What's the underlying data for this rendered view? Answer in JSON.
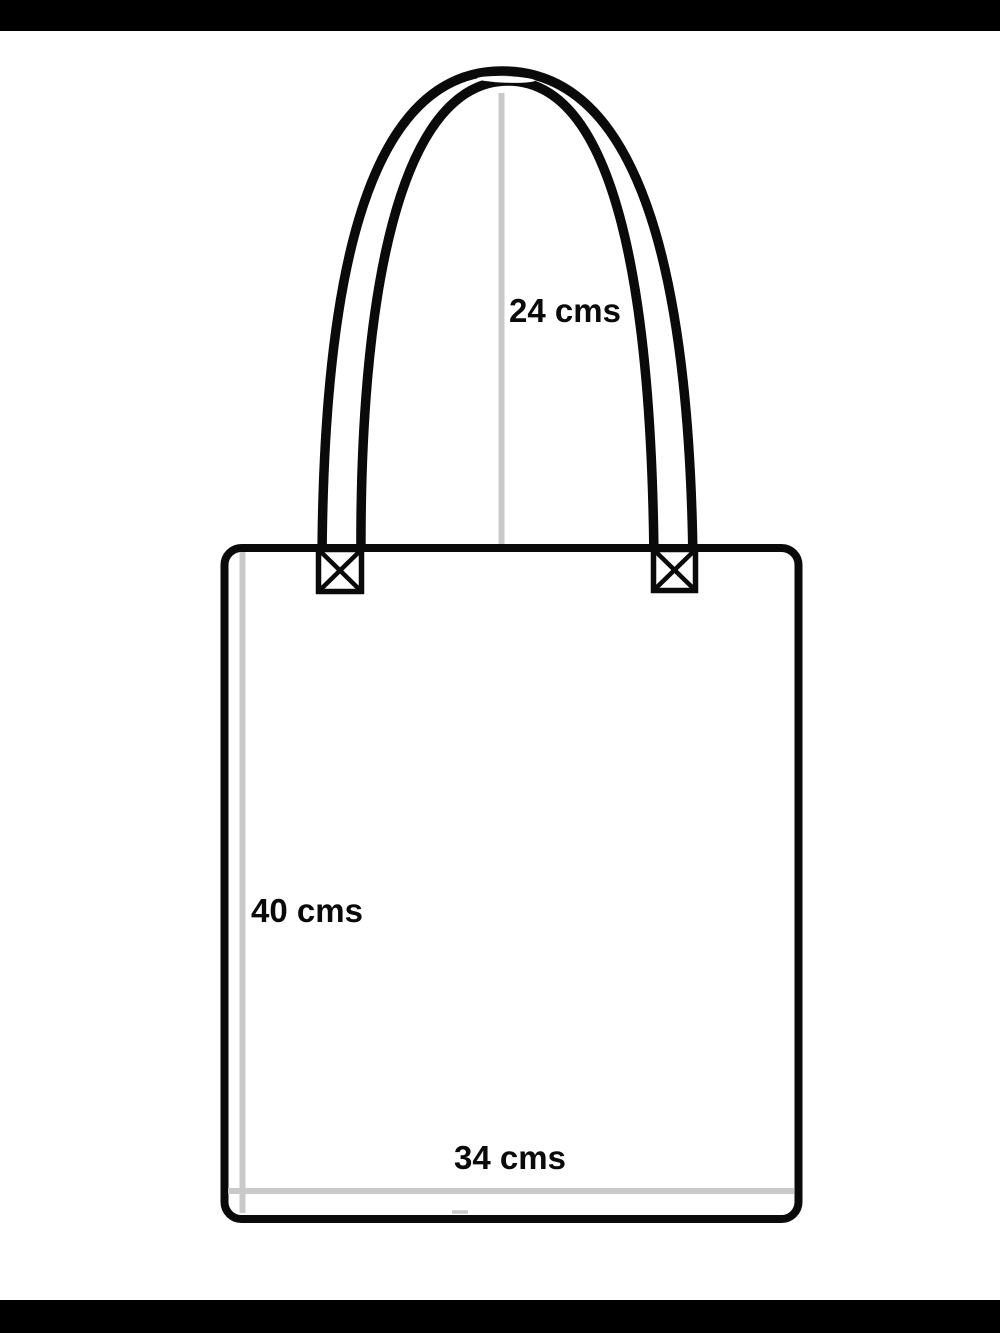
{
  "diagram": {
    "subject": "tote-bag-measurement-diagram",
    "labels": {
      "handle_height": "24 cms",
      "bag_height": "40 cms",
      "bag_width": "34 cms"
    },
    "measurements": {
      "handle_height_value": 24,
      "bag_height_value": 40,
      "bag_width_value": 34,
      "unit": "cms"
    }
  },
  "colors": {
    "ink": "#0a0a0a",
    "guide": "#c9c9c9",
    "letterbox": "#000000",
    "background": "#ffffff"
  }
}
